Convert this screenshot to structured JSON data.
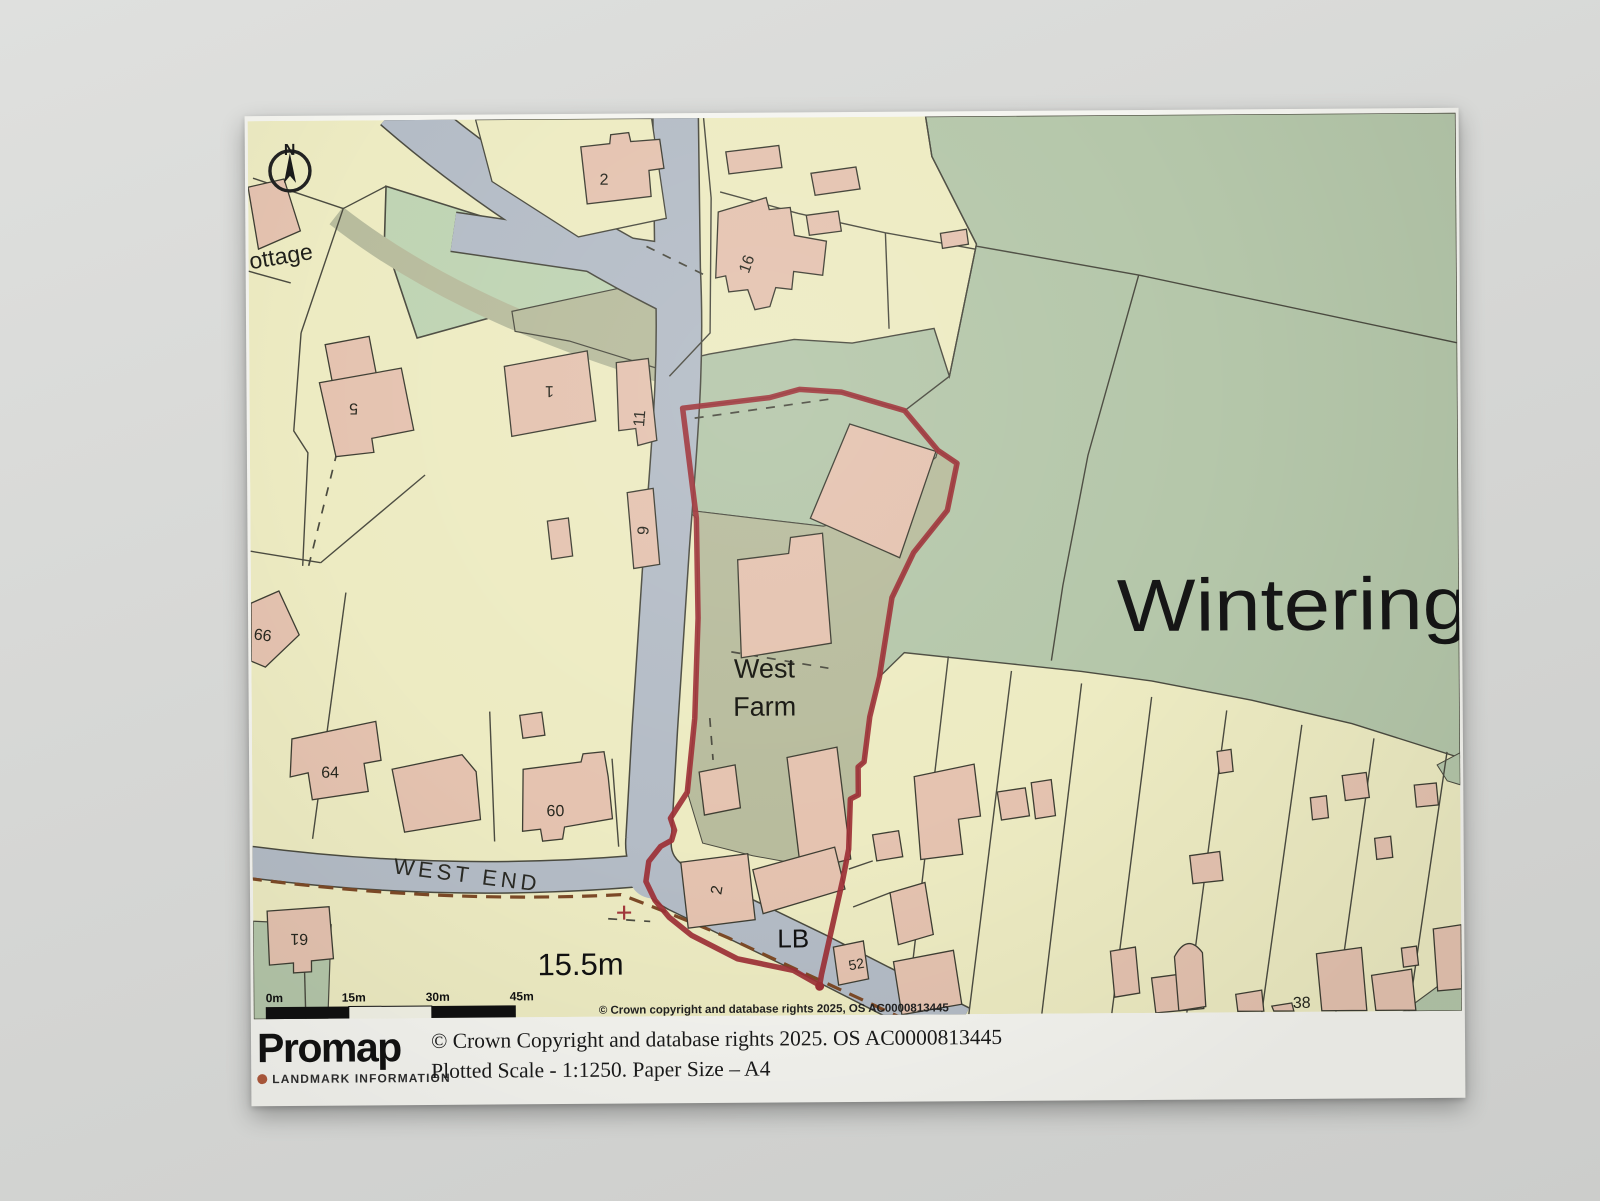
{
  "scene": {
    "surface_color": "#d6d7d5",
    "paper_color": "#f5f5f0"
  },
  "map": {
    "colors": {
      "parcel_cream": "#edebc2",
      "field_green": "#b5c7aa",
      "green_space": "#bfd4b3",
      "farmyard_olive": "#b8bc9d",
      "road_grey": "#b4bcc6",
      "building_salmon": "#e5c3b0",
      "line_dark": "#4b4b40",
      "site_boundary_red": "#9d3036",
      "track_dash_brown": "#7d4a27"
    },
    "north_label": "N",
    "plot_labels": [
      {
        "text": "2"
      },
      {
        "text": "16"
      },
      {
        "text": "5"
      },
      {
        "text": "1"
      },
      {
        "text": "11"
      },
      {
        "text": "9"
      },
      {
        "text": "66"
      },
      {
        "text": "64"
      },
      {
        "text": "60"
      },
      {
        "text": "61"
      },
      {
        "text": "2"
      },
      {
        "text": "52"
      },
      {
        "text": "38"
      }
    ],
    "place_labels": {
      "cottage_partial": "ottage",
      "site_name_line1": "West",
      "site_name_line2": "Farm",
      "road_name": "WEST END",
      "area_name": "Wintering",
      "letter_box": "LB",
      "spot_height": "15.5m"
    },
    "scale_bar": {
      "ticks": [
        "0m",
        "15m",
        "30m",
        "45m"
      ]
    },
    "copyright": "© Crown copyright and database rights 2025, OS AC0000813445"
  },
  "footer": {
    "logo_text": "Promap",
    "logo_subtext": "LANDMARK INFORMATION",
    "copyright_line": "© Crown Copyright and database rights 2025. OS AC0000813445",
    "scale_line": "Plotted Scale - 1:1250. Paper Size – A4"
  }
}
